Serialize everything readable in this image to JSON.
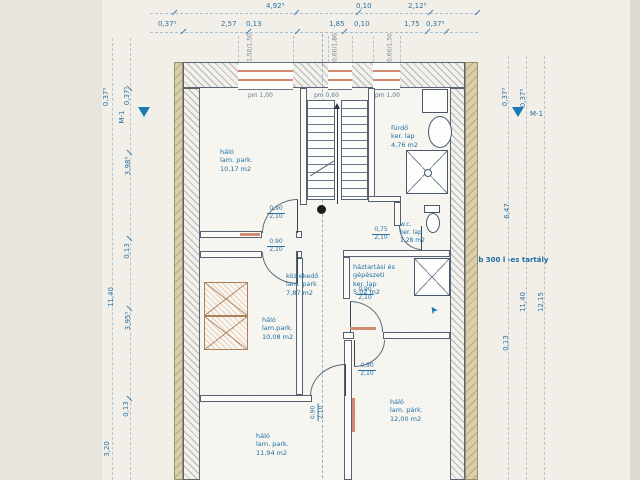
{
  "dims": {
    "top1": [
      "4,92⁵",
      "0,10",
      "2,12⁵"
    ],
    "top2": [
      "0,37⁵",
      "2,57",
      "0,13",
      "1,85",
      "0,10",
      "1,75",
      "0,37⁵"
    ],
    "left_outer": [
      "0,37⁵",
      "11,40",
      "3,20"
    ],
    "left_inner": [
      "0,37⁵",
      "3,98⁵",
      "0,13",
      "3,95⁵",
      "0,13"
    ],
    "right_inner": [
      "0,37⁵",
      "6,47",
      "0,13"
    ],
    "right_mid": [
      "0,37⁵",
      "11,40"
    ],
    "right_outer": [
      "12,15"
    ]
  },
  "markers": {
    "section": "M-1"
  },
  "windows": {
    "specs": [
      "1,50/1,50",
      "0,60/1,80",
      "0,60/1,50"
    ],
    "parapets": [
      "pm 1,00",
      "pm 0,60",
      "pm 1,00"
    ]
  },
  "doors": {
    "std_w": "0,90",
    "std_h": "2,10",
    "wc_w": "0,75",
    "wc_h": "2,10"
  },
  "rooms": [
    {
      "name": "háló",
      "floor": "lam. park.",
      "area": "10,17 m2"
    },
    {
      "name": "fürdő",
      "floor": "ker. lap",
      "area": "4,76 m2"
    },
    {
      "name": "w.c.",
      "floor": "ker. lap",
      "area": "1,28 m2"
    },
    {
      "name": "közlekedő",
      "floor": "lam. park",
      "area": "7,87 m2"
    },
    {
      "name": "háztartási és gépészeti",
      "floor": "ker. lap",
      "area": "5,02 m2"
    },
    {
      "name": "háló",
      "floor": "lam.park.",
      "area": "10,08 m2"
    },
    {
      "name": "háló",
      "floor": "lam. park.",
      "area": "11,94 m2"
    },
    {
      "name": "háló",
      "floor": "lam. párk.",
      "area": "12,00 m2"
    }
  ],
  "annotations": {
    "tanks": "2 db 300 l -es tartály"
  }
}
